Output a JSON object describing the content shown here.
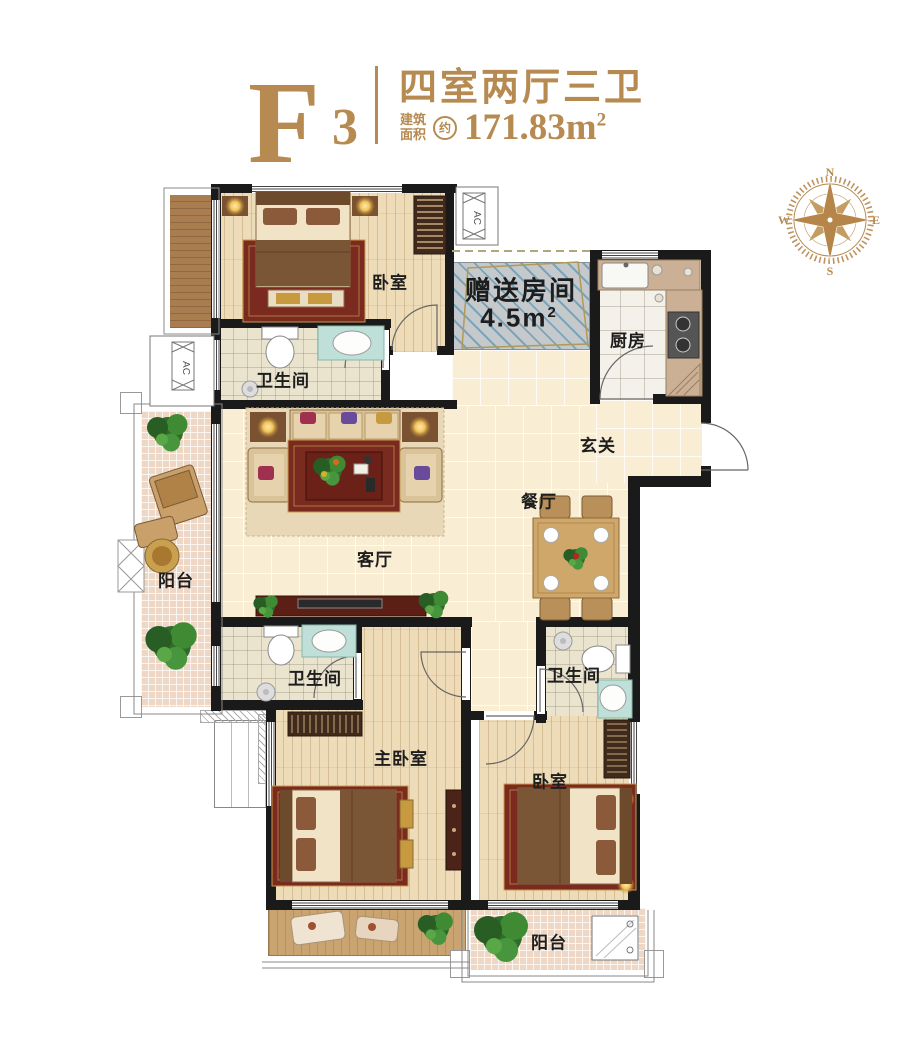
{
  "header": {
    "unit_letter": "F",
    "unit_number": "3",
    "title": "四室两厅三卫",
    "area_label_line1": "建筑",
    "area_label_line2": "面积",
    "area_approx": "约",
    "area_value": "171.83m",
    "area_sup": "2"
  },
  "compass": {
    "north": "N",
    "east": "E",
    "south": "S",
    "west": "W"
  },
  "rooms": {
    "bedroom_top": "卧室",
    "bathroom_top": "卫生间",
    "gift_room_name": "赠送房间",
    "gift_room_area": "4.5m",
    "gift_room_area_sup": "2",
    "kitchen": "厨房",
    "entry": "玄关",
    "dining": "餐厅",
    "living": "客厅",
    "balcony_left": "阳台",
    "bathroom_master": "卫生间",
    "master_bedroom": "主卧室",
    "bathroom_right": "卫生间",
    "bedroom_bottom": "卧室",
    "balcony_bottom": "阳台"
  },
  "markers": {
    "ac": "AC"
  },
  "colors": {
    "accent_gold": "#b68a50",
    "wall": "#1a1a1a",
    "tile_floor": "#f9edd3",
    "wood_floor": "#eedcb9",
    "bath_floor": "#eae4cf",
    "mosaic_floor": "#eed7c5",
    "gift_fill": "#c6c9cb",
    "gift_stripe": "#79a5bb",
    "rug": "#7a2a1e",
    "label_text": "#1d1d1d"
  }
}
